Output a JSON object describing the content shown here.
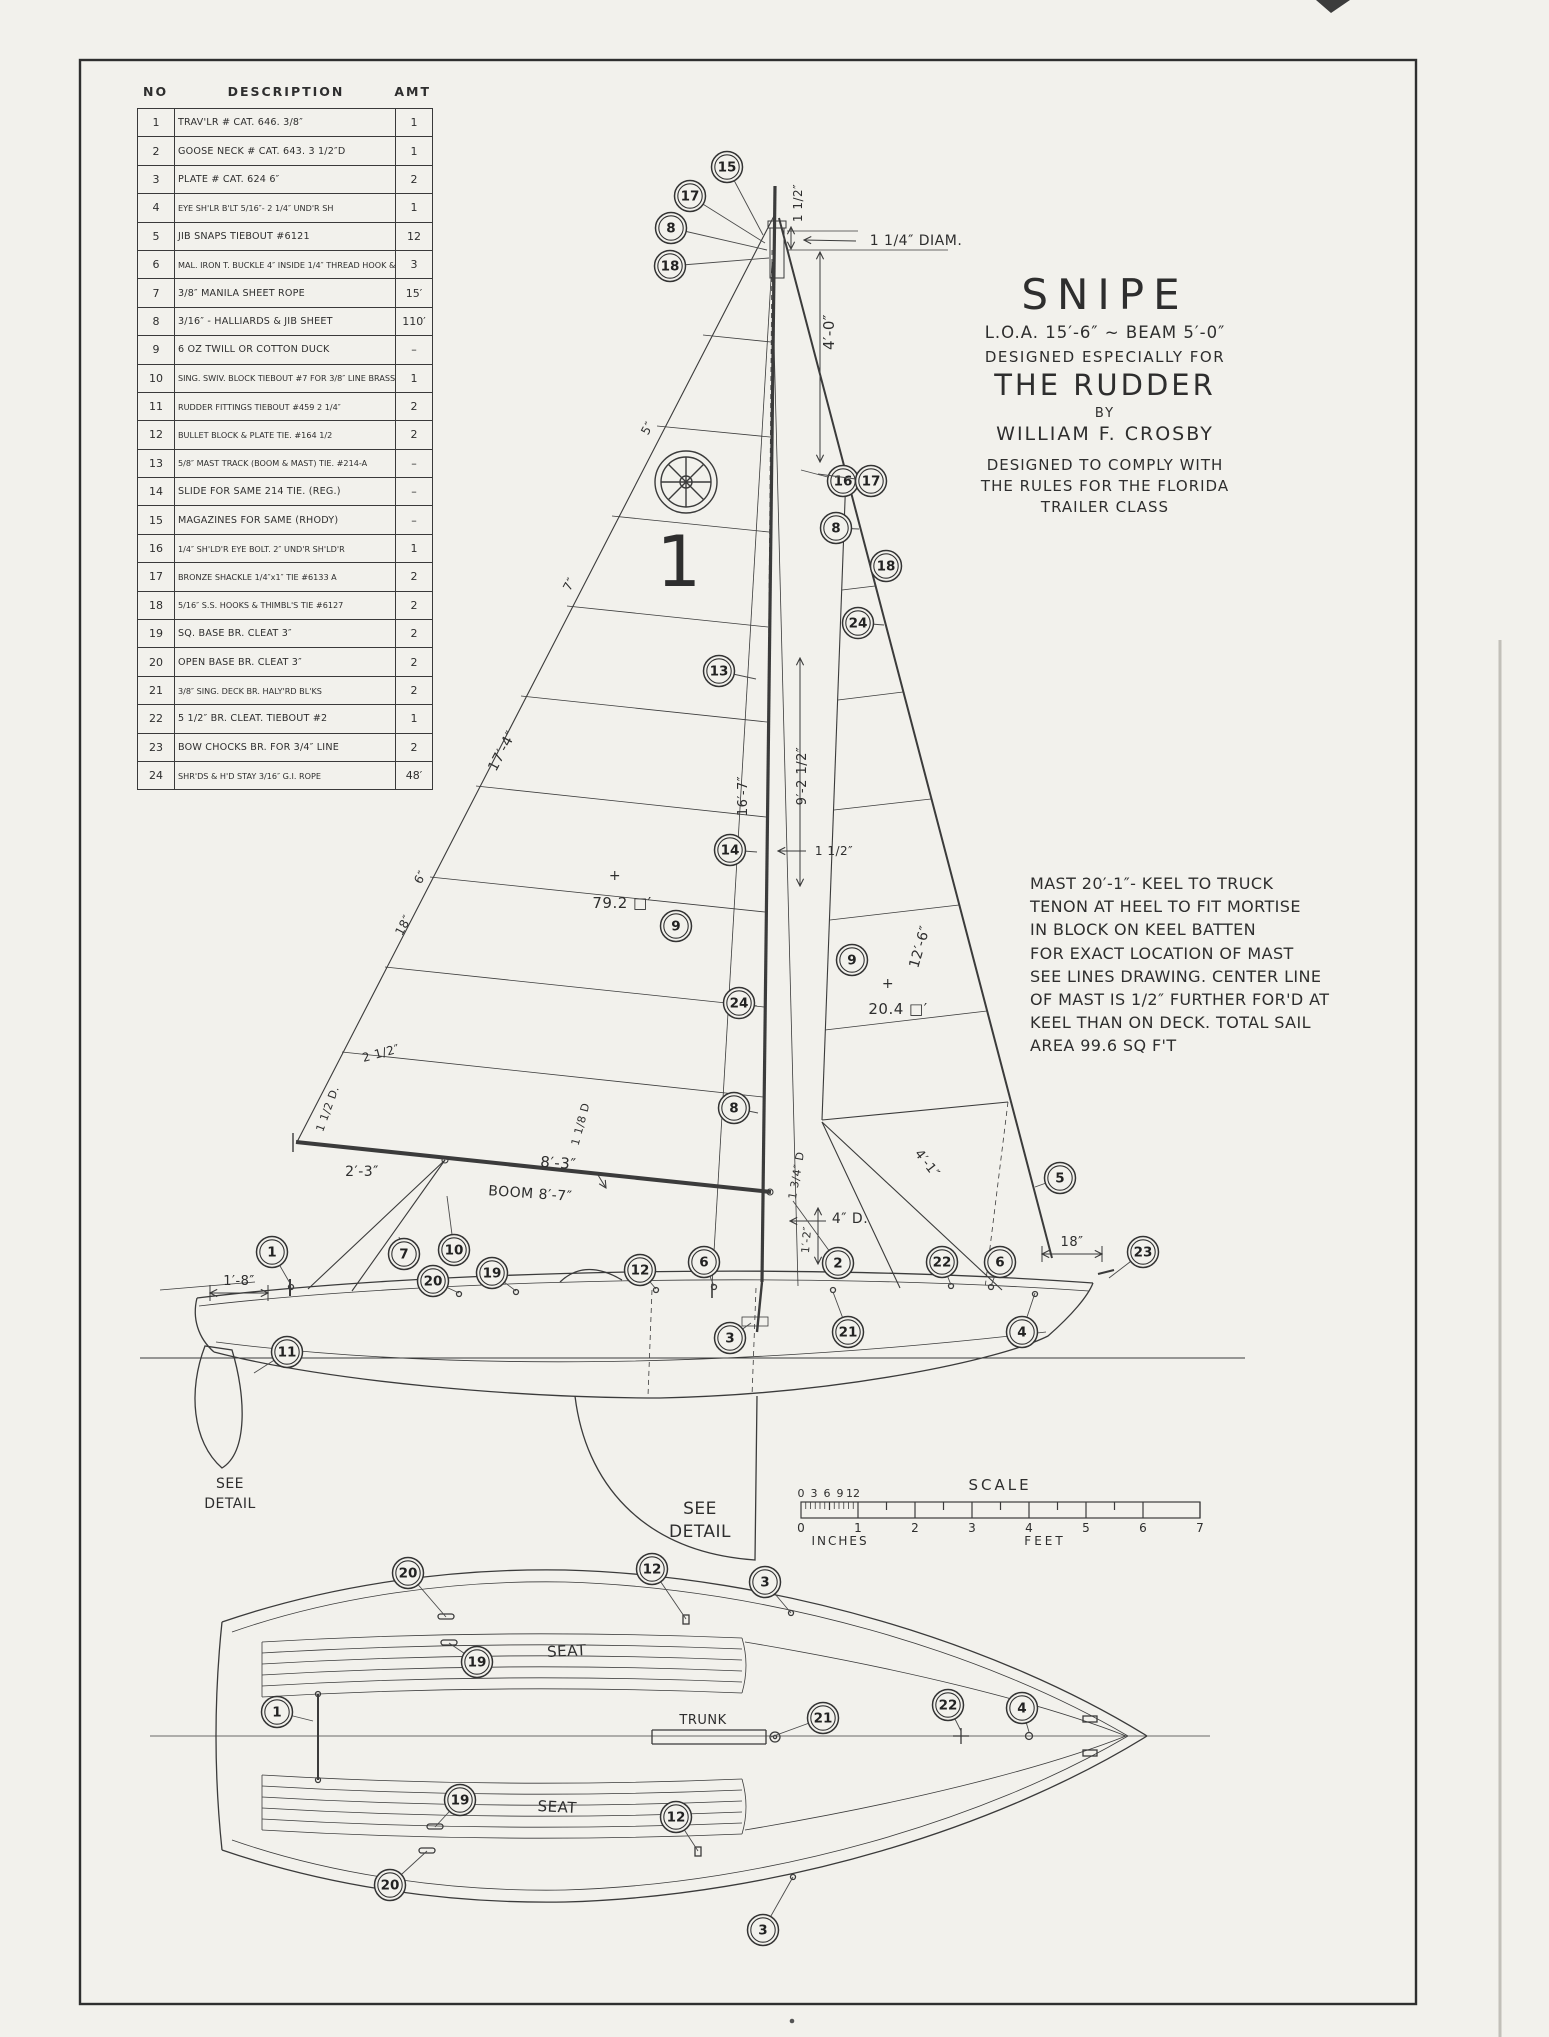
{
  "parts_table": {
    "headers": [
      "NO",
      "DESCRIPTION",
      "AMT"
    ],
    "rows": [
      [
        "1",
        "TRAV'LR  # CAT. 646. 3/8″",
        "1"
      ],
      [
        "2",
        "GOOSE NECK # CAT. 643. 3 1/2″D",
        "1"
      ],
      [
        "3",
        "PLATE  # CAT. 624  6″",
        "2"
      ],
      [
        "4",
        "EYE SH'LR B'LT 5/16″- 2 1/4″ UND'R SH",
        "1"
      ],
      [
        "5",
        "JIB SNAPS  TIEBOUT #6121",
        "12"
      ],
      [
        "6",
        "MAL. IRON T. BUCKLE 4″ INSIDE 1/4″ THREAD HOOK & EYE",
        "3"
      ],
      [
        "7",
        "3/8″ MANILA SHEET ROPE",
        "15′"
      ],
      [
        "8",
        "3/16″ - HALLIARDS & JIB SHEET",
        "110′"
      ],
      [
        "9",
        "6 OZ TWILL OR COTTON DUCK",
        "–"
      ],
      [
        "10",
        "SING. SWIV. BLOCK TIEBOUT #7 FOR 3/8″ LINE BRASS",
        "1"
      ],
      [
        "11",
        "RUDDER FITTINGS TIEBOUT #459 2 1/4″",
        "2"
      ],
      [
        "12",
        "BULLET BLOCK & PLATE TIE. #164 1/2",
        "2"
      ],
      [
        "13",
        "5/8″ MAST TRACK (BOOM & MAST) TIE. #214-A",
        "–"
      ],
      [
        "14",
        "SLIDE FOR SAME 214 TIE. (REG.)",
        "–"
      ],
      [
        "15",
        "MAGAZINES FOR SAME (RHODY)",
        "–"
      ],
      [
        "16",
        "1/4″ SH'LD'R EYE BOLT. 2″ UND'R SH'LD'R",
        "1"
      ],
      [
        "17",
        "BRONZE SHACKLE 1/4″x1″ TIE #6133 A",
        "2"
      ],
      [
        "18",
        "5/16″ S.S. HOOKS & THIMBL'S TIE #6127",
        "2"
      ],
      [
        "19",
        "SQ. BASE BR. CLEAT  3″",
        "2"
      ],
      [
        "20",
        "OPEN BASE BR. CLEAT  3″",
        "2"
      ],
      [
        "21",
        "3/8″ SING. DECK BR. HALY'RD BL'KS",
        "2"
      ],
      [
        "22",
        "5 1/2″ BR. CLEAT. TIEBOUT #2",
        "1"
      ],
      [
        "23",
        "BOW CHOCKS BR. FOR 3/4″ LINE",
        "2"
      ],
      [
        "24",
        "SHR'DS & H'D STAY 3/16″ G.I. ROPE",
        "48′"
      ]
    ]
  },
  "title_block": {
    "name": "SNIPE",
    "loa": "L.O.A. 15′-6″ ~ BEAM 5′-0″",
    "designed_for": "DESIGNED ESPECIALLY FOR",
    "magazine": "THE RUDDER",
    "by": "BY",
    "designer": "WILLIAM F. CROSBY",
    "comply": "DESIGNED TO COMPLY WITH\nTHE RULES FOR THE FLORIDA\nTRAILER CLASS"
  },
  "mast_note": "MAST 20′-1″- KEEL TO TRUCK\nTENON AT HEEL TO FIT MORTISE\nIN BLOCK ON KEEL BATTEN\nFOR EXACT LOCATION OF MAST\nSEE LINES DRAWING. CENTER LINE\nOF MAST IS 1/2″ FURTHER FOR'D AT\nKEEL THAN ON DECK. TOTAL SAIL\nAREA 99.6 SQ F'T",
  "scale_bar": {
    "title": "SCALE",
    "inch_ticks": [
      "0",
      "3",
      "6",
      "9",
      "12"
    ],
    "feet_ticks": [
      "0",
      "1",
      "2",
      "3",
      "4",
      "5",
      "6",
      "7"
    ],
    "inches_label": "INCHES",
    "feet_label": "FEET"
  },
  "labels": [
    {
      "t": "1 1/2″",
      "x": 802,
      "y": 203,
      "r": -90,
      "fs": 12
    },
    {
      "t": "1 1/4″ DIAM.",
      "x": 916,
      "y": 245,
      "r": 0,
      "fs": 14
    },
    {
      "t": "4′-0″",
      "x": 834,
      "y": 332,
      "r": -90,
      "fs": 15
    },
    {
      "t": "5″",
      "x": 651,
      "y": 430,
      "r": -62,
      "fs": 12
    },
    {
      "t": "7″",
      "x": 573,
      "y": 586,
      "r": -62,
      "fs": 12
    },
    {
      "t": "17′-4″",
      "x": 506,
      "y": 753,
      "r": -62,
      "fs": 14
    },
    {
      "t": "16′-7″",
      "x": 747,
      "y": 796,
      "r": -90,
      "fs": 13
    },
    {
      "t": "9′-2 1/2″",
      "x": 806,
      "y": 776,
      "r": -90,
      "fs": 13
    },
    {
      "t": "1 1/2″",
      "x": 834,
      "y": 855,
      "r": 0,
      "fs": 12
    },
    {
      "t": "12′-6″",
      "x": 924,
      "y": 948,
      "r": -74,
      "fs": 14
    },
    {
      "t": "79.2 □′",
      "x": 622,
      "y": 908,
      "r": 0,
      "fs": 15
    },
    {
      "t": "+",
      "x": 615,
      "y": 880,
      "r": 0,
      "fs": 14
    },
    {
      "t": "20.4 □′",
      "x": 898,
      "y": 1014,
      "r": 0,
      "fs": 15
    },
    {
      "t": "+",
      "x": 888,
      "y": 988,
      "r": 0,
      "fs": 14
    },
    {
      "t": "6″",
      "x": 424,
      "y": 879,
      "r": -62,
      "fs": 12
    },
    {
      "t": "18″",
      "x": 407,
      "y": 927,
      "r": -62,
      "fs": 12
    },
    {
      "t": "2 1/2″",
      "x": 382,
      "y": 1057,
      "r": -15,
      "fs": 12
    },
    {
      "t": "1 1/2 D.",
      "x": 331,
      "y": 1110,
      "r": -70,
      "fs": 11
    },
    {
      "t": "1 1/8 D",
      "x": 584,
      "y": 1125,
      "r": -75,
      "fs": 11
    },
    {
      "t": "2′-3″",
      "x": 362,
      "y": 1176,
      "r": 0,
      "fs": 14
    },
    {
      "t": "8′-3″",
      "x": 558,
      "y": 1168,
      "r": 4,
      "fs": 15
    },
    {
      "t": "BOOM 8′-7″",
      "x": 530,
      "y": 1198,
      "r": 4,
      "fs": 14
    },
    {
      "t": "1 3/4″ D",
      "x": 800,
      "y": 1176,
      "r": -80,
      "fs": 11
    },
    {
      "t": "4″ D.",
      "x": 850,
      "y": 1223,
      "r": 0,
      "fs": 14
    },
    {
      "t": "1′-2″",
      "x": 810,
      "y": 1240,
      "r": -85,
      "fs": 11
    },
    {
      "t": "4′-1″",
      "x": 924,
      "y": 1166,
      "r": 52,
      "fs": 13
    },
    {
      "t": "18″",
      "x": 1072,
      "y": 1246,
      "r": 0,
      "fs": 13
    },
    {
      "t": "1′-8″",
      "x": 239,
      "y": 1285,
      "r": 0,
      "fs": 13
    },
    {
      "t": "SEE",
      "x": 230,
      "y": 1488,
      "r": 0,
      "fs": 14
    },
    {
      "t": "DETAIL",
      "x": 230,
      "y": 1508,
      "r": 0,
      "fs": 14
    },
    {
      "t": "SEE",
      "x": 700,
      "y": 1514,
      "r": 0,
      "fs": 17
    },
    {
      "t": "DETAIL",
      "x": 700,
      "y": 1537,
      "r": 0,
      "fs": 17
    },
    {
      "t": "SEAT",
      "x": 567,
      "y": 1656,
      "r": -3,
      "fs": 15
    },
    {
      "t": "SEAT",
      "x": 557,
      "y": 1812,
      "r": 3,
      "fs": 15
    },
    {
      "t": "TRUNK",
      "x": 703,
      "y": 1724,
      "r": 0,
      "fs": 13
    },
    {
      "t": "1",
      "x": 679,
      "y": 586,
      "r": 0,
      "fs": 70
    }
  ],
  "callouts": [
    {
      "n": "15",
      "x": 727,
      "y": 167,
      "tx": 763,
      "ty": 235
    },
    {
      "n": "17",
      "x": 690,
      "y": 196,
      "tx": 765,
      "ty": 243
    },
    {
      "n": "8",
      "x": 671,
      "y": 228,
      "tx": 767,
      "ty": 250
    },
    {
      "n": "18",
      "x": 670,
      "y": 266,
      "tx": 769,
      "ty": 258
    },
    {
      "n": "16",
      "x": 843,
      "y": 481,
      "tx": 801,
      "ty": 470
    },
    {
      "n": "17",
      "x": 871,
      "y": 481,
      "tx": 818,
      "ty": 474
    },
    {
      "n": "8",
      "x": 836,
      "y": 528,
      "tx": 859,
      "ty": 529
    },
    {
      "n": "18",
      "x": 886,
      "y": 566,
      "tx": 869,
      "ty": 563
    },
    {
      "n": "24",
      "x": 858,
      "y": 623,
      "tx": 884,
      "ty": 625
    },
    {
      "n": "13",
      "x": 719,
      "y": 671,
      "tx": 756,
      "ty": 679
    },
    {
      "n": "14",
      "x": 730,
      "y": 850,
      "tx": 757,
      "ty": 852
    },
    {
      "n": "9",
      "x": 676,
      "y": 926
    },
    {
      "n": "24",
      "x": 739,
      "y": 1003,
      "tx": 757,
      "ty": 1006
    },
    {
      "n": "8",
      "x": 734,
      "y": 1108,
      "tx": 758,
      "ty": 1113
    },
    {
      "n": "9",
      "x": 852,
      "y": 960
    },
    {
      "n": "5",
      "x": 1060,
      "y": 1178,
      "tx": 1035,
      "ty": 1187
    },
    {
      "n": "1",
      "x": 272,
      "y": 1252,
      "tx": 291,
      "ty": 1285
    },
    {
      "n": "7",
      "x": 404,
      "y": 1254,
      "tx": 399,
      "ty": 1237
    },
    {
      "n": "10",
      "x": 454,
      "y": 1250,
      "tx": 447,
      "ty": 1196
    },
    {
      "n": "20",
      "x": 433,
      "y": 1281,
      "tx": 459,
      "ty": 1293
    },
    {
      "n": "19",
      "x": 492,
      "y": 1273,
      "tx": 516,
      "ty": 1291
    },
    {
      "n": "12",
      "x": 640,
      "y": 1270,
      "tx": 656,
      "ty": 1289
    },
    {
      "n": "6",
      "x": 704,
      "y": 1262,
      "tx": 714,
      "ty": 1286
    },
    {
      "n": "2",
      "x": 838,
      "y": 1263,
      "tx": 793,
      "ty": 1201
    },
    {
      "n": "22",
      "x": 942,
      "y": 1262,
      "tx": 951,
      "ty": 1285
    },
    {
      "n": "6",
      "x": 1000,
      "y": 1262,
      "tx": 991,
      "ty": 1286
    },
    {
      "n": "23",
      "x": 1143,
      "y": 1252,
      "tx": 1109,
      "ty": 1278
    },
    {
      "n": "4",
      "x": 1022,
      "y": 1332,
      "tx": 1035,
      "ty": 1293
    },
    {
      "n": "21",
      "x": 848,
      "y": 1332,
      "tx": 833,
      "ty": 1292
    },
    {
      "n": "3",
      "x": 730,
      "y": 1338,
      "tx": 751,
      "ty": 1323
    },
    {
      "n": "11",
      "x": 287,
      "y": 1352,
      "tx": 254,
      "ty": 1373
    },
    {
      "n": "20",
      "x": 408,
      "y": 1573,
      "tx": 446,
      "ty": 1617
    },
    {
      "n": "12",
      "x": 652,
      "y": 1569,
      "tx": 686,
      "ty": 1619
    },
    {
      "n": "3",
      "x": 765,
      "y": 1582,
      "tx": 791,
      "ty": 1613
    },
    {
      "n": "19",
      "x": 477,
      "y": 1662,
      "tx": 449,
      "ty": 1643
    },
    {
      "n": "1",
      "x": 277,
      "y": 1712,
      "tx": 313,
      "ty": 1721
    },
    {
      "n": "21",
      "x": 823,
      "y": 1718,
      "tx": 771,
      "ty": 1737
    },
    {
      "n": "22",
      "x": 948,
      "y": 1705,
      "tx": 961,
      "ty": 1731
    },
    {
      "n": "4",
      "x": 1022,
      "y": 1708,
      "tx": 1029,
      "ty": 1732
    },
    {
      "n": "19",
      "x": 460,
      "y": 1800,
      "tx": 435,
      "ty": 1827
    },
    {
      "n": "12",
      "x": 676,
      "y": 1817,
      "tx": 698,
      "ty": 1851
    },
    {
      "n": "20",
      "x": 390,
      "y": 1885,
      "tx": 427,
      "ty": 1851
    },
    {
      "n": "3",
      "x": 763,
      "y": 1930,
      "tx": 793,
      "ty": 1877
    }
  ]
}
